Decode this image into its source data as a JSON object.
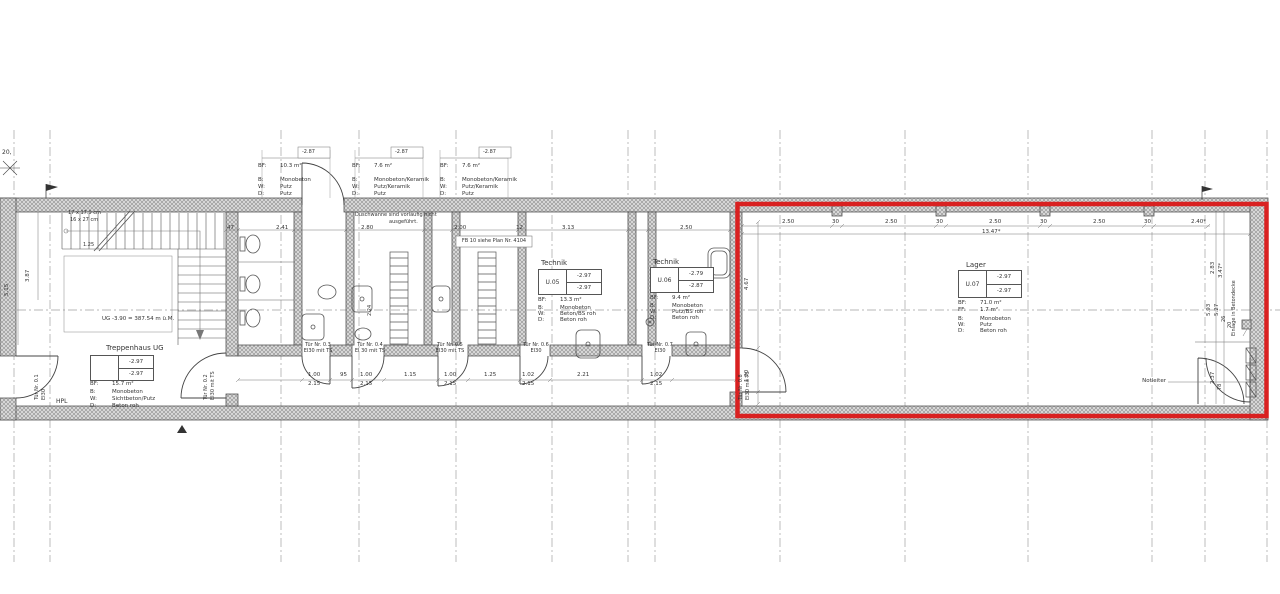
{
  "colors": {
    "highlight_red": "#d92121",
    "line": "#3c3c3c",
    "wall_gray": "#dcdcdc",
    "dim_text": "#333333"
  },
  "corner": {
    "label": "20,"
  },
  "top_specs": [
    {
      "elev": "-2.87",
      "rows": [
        {
          "k": "BF:",
          "v": "10.3 m²"
        },
        {
          "k": "B:",
          "v": "Monobeton"
        },
        {
          "k": "W:",
          "v": "Putz"
        },
        {
          "k": "D:",
          "v": "Putz"
        }
      ]
    },
    {
      "elev": "-2.87",
      "rows": [
        {
          "k": "BF:",
          "v": "7.6 m²"
        },
        {
          "k": "B:",
          "v": "Monobeton/Keramik"
        },
        {
          "k": "W:",
          "v": "Putz/Keramik"
        },
        {
          "k": "D:",
          "v": "Putz"
        }
      ]
    },
    {
      "elev": "-2.87",
      "rows": [
        {
          "k": "BF:",
          "v": "7.6 m²"
        },
        {
          "k": "B:",
          "v": "Monobeton/Keramik"
        },
        {
          "k": "W:",
          "v": "Putz/Keramik"
        },
        {
          "k": "D:",
          "v": "Putz"
        }
      ]
    }
  ],
  "rooms": [
    {
      "title": "Treppenhaus UG",
      "nr": "",
      "elev_top": "-2.97",
      "elev_bot": "-2.97",
      "rows": [
        {
          "k": "BF:",
          "v": "15.7 m²"
        },
        {
          "k": "B:",
          "v": "Monobeton"
        },
        {
          "k": "W:",
          "v": "Sichtbeton/Putz"
        },
        {
          "k": "D:",
          "v": "Beton roh"
        }
      ]
    },
    {
      "title": "Technik",
      "nr": "U.05",
      "elev_top": "-2.97",
      "elev_bot": "-2.97",
      "rows": [
        {
          "k": "BF:",
          "v": "13.3 m²"
        },
        {
          "k": "B:",
          "v": "Monobeton"
        },
        {
          "k": "W:",
          "v": "Beton/BS roh"
        },
        {
          "k": "D:",
          "v": "Beton roh"
        }
      ]
    },
    {
      "title": "Technik",
      "nr": "U.06",
      "elev_top": "-2.79",
      "elev_bot": "-2.87",
      "rows": [
        {
          "k": "BF:",
          "v": "9.4 m²"
        },
        {
          "k": "B:",
          "v": "Monobeton"
        },
        {
          "k": "W:",
          "v": "Putz/BS roh"
        },
        {
          "k": "D:",
          "v": "Beton roh"
        }
      ]
    },
    {
      "title": "Lager",
      "nr": "U.07",
      "elev_top": "-2.97",
      "elev_bot": "-2.97",
      "rows": [
        {
          "k": "BF:",
          "v": "71.0 m²"
        },
        {
          "k": "FF:",
          "v": "1.7 m²"
        },
        {
          "k": "B:",
          "v": "Monobeton"
        },
        {
          "k": "W:",
          "v": "Putz"
        },
        {
          "k": "D:",
          "v": "Beton roh"
        }
      ]
    }
  ],
  "doors": [
    {
      "line1": "Tür Nr. 0.1",
      "line2": "EI30"
    },
    {
      "line1": "Tür Nr. 0.2",
      "line2": "EI30 mit TS"
    },
    {
      "line1": "Tür Nr. 0.3",
      "line2": "EI30 mit TS"
    },
    {
      "line1": "Tür Nr. 0.4",
      "line2": "EI 30 mit TS"
    },
    {
      "line1": "Tür Nr. 0.5",
      "line2": "EI30 mit TS"
    },
    {
      "line1": "Tür Nr. 0.6",
      "line2": "EI30"
    },
    {
      "line1": "Tür Nr. 0.7",
      "line2": "EI30"
    },
    {
      "line1": "Tür Nr. 0.8",
      "line2": "EI30 mit TS"
    }
  ],
  "notes": {
    "shower1": "Duschwanne sind vorläufig nicht",
    "shower2": "ausgeführt.",
    "fb": "FB 10 siehe Plan Nr. 4104",
    "level": "UG -3.90 = 387.54 m ü.M.",
    "stairs1": "17 x 17.9 cm",
    "stairs2": "16 x 27 cm",
    "hpl": "HPL",
    "notleiter": "Notleiter",
    "einlage": "Einlage in Betondecke"
  },
  "dims": {
    "upper": [
      "47",
      "2.41",
      "2.80",
      "2.00",
      "12",
      "3.13",
      "2.50"
    ],
    "red_top": [
      "2.50",
      "30",
      "2.50",
      "30",
      "2.50",
      "30",
      "2.50",
      "30",
      "2.40*"
    ],
    "red_total": "13.47*",
    "bottom": [
      {
        "w": "1.00",
        "h": "2.15"
      },
      {
        "w": "95"
      },
      {
        "w": "1.00",
        "h": "2.15"
      },
      {
        "w": "1.15"
      },
      {
        "w": "1.00",
        "h": "2.15"
      },
      {
        "w": "1.25"
      },
      {
        "w": "1.02",
        "h": "2.15"
      },
      {
        "w": "2.21"
      },
      {
        "w": "1.02",
        "h": "2.15"
      }
    ],
    "left_v": [
      "5.15",
      "3.87"
    ],
    "stair": [
      "1.25"
    ],
    "lager_v": [
      "4.67",
      "1.20"
    ],
    "right_v": [
      "2.83",
      "3.47*",
      "5.93",
      "5.27",
      "26",
      "20",
      "2.37",
      "78"
    ],
    "shaft": "2.24"
  }
}
